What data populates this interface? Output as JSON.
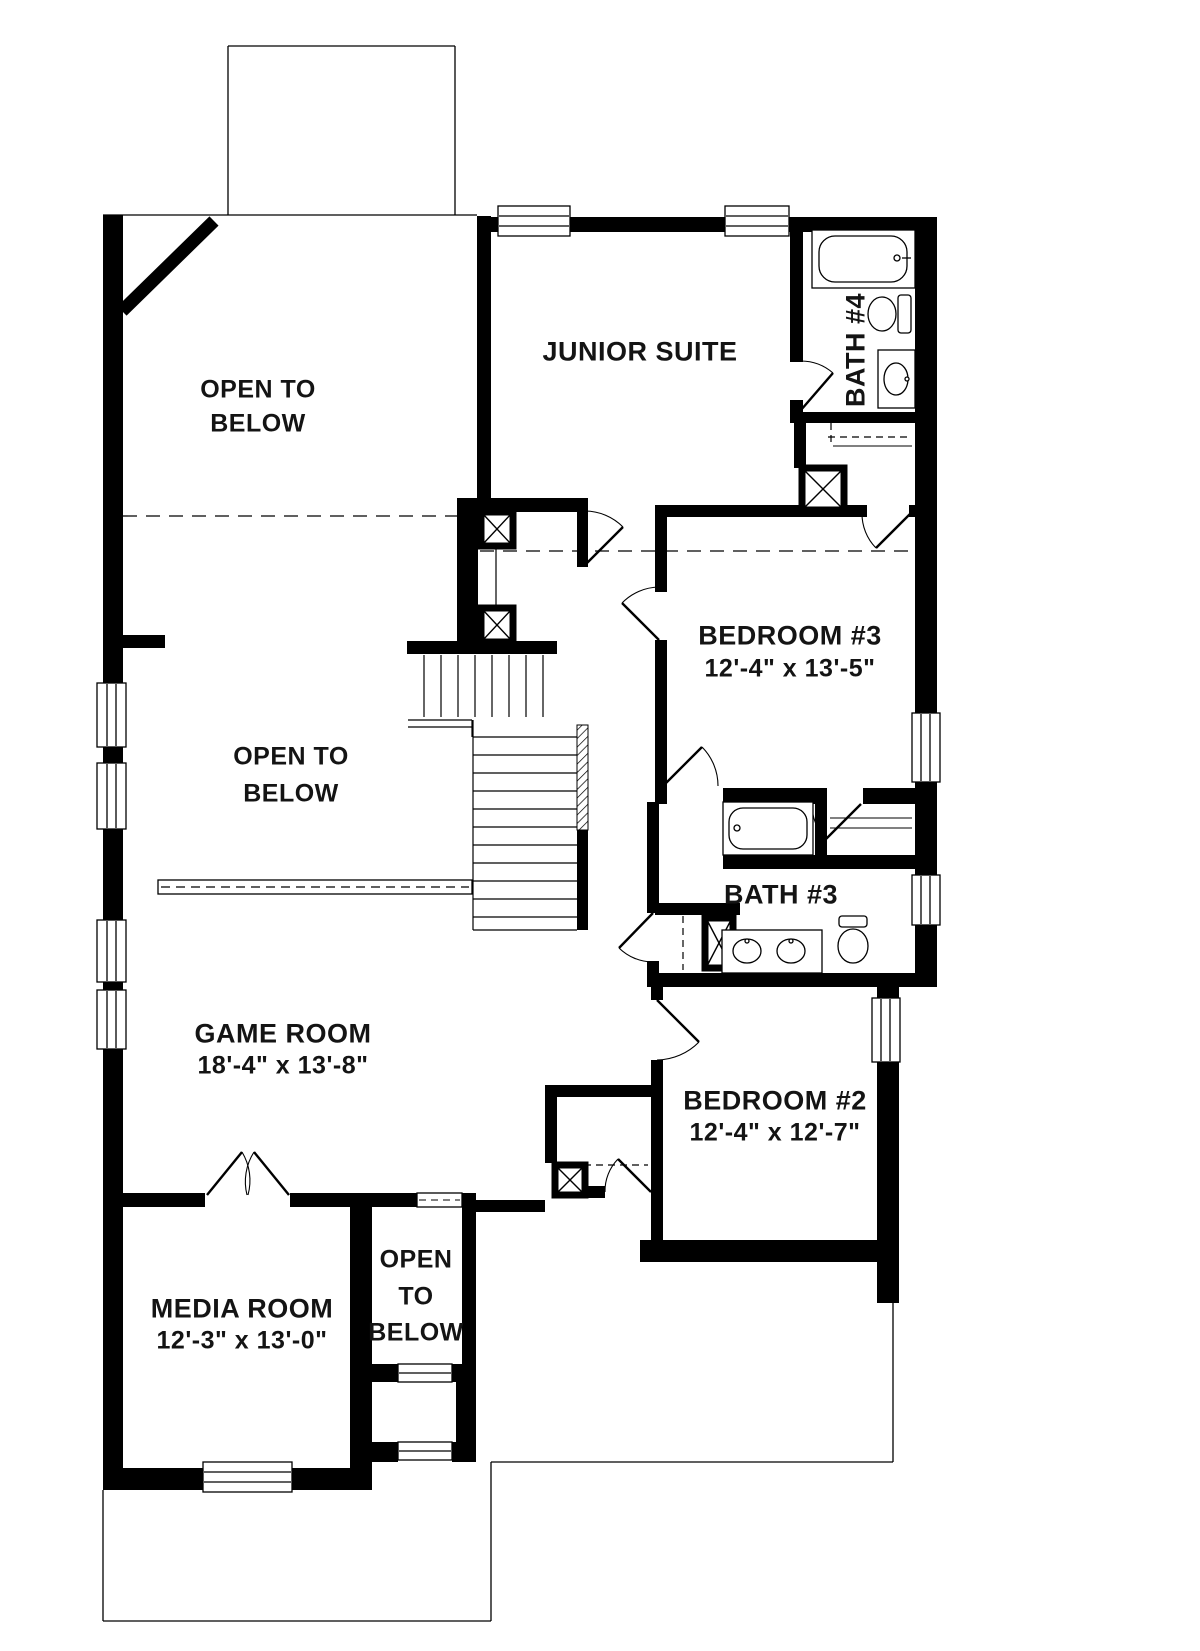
{
  "document_type": "floor-plan",
  "colors": {
    "wall": "#000000",
    "background": "#ffffff",
    "text": "#141414"
  },
  "rooms": {
    "open_below_top": {
      "line1": "OPEN TO",
      "line2": "BELOW"
    },
    "junior_suite": {
      "name": "JUNIOR SUITE"
    },
    "bath4": {
      "name": "BATH #4"
    },
    "bedroom3": {
      "name": "BEDROOM #3",
      "dims": "12'-4\" x 13'-5\""
    },
    "open_below_mid": {
      "line1": "OPEN TO",
      "line2": "BELOW"
    },
    "bath3": {
      "name": "BATH #3"
    },
    "game_room": {
      "name": "GAME ROOM",
      "dims": "18'-4\" x 13'-8\""
    },
    "bedroom2": {
      "name": "BEDROOM #2",
      "dims": "12'-4\" x 12'-7\""
    },
    "media_room": {
      "name": "MEDIA ROOM",
      "dims": "12'-3\" x 13'-0\""
    },
    "open_below_bottom": {
      "line1": "OPEN",
      "line2": "TO",
      "line3": "BELOW"
    }
  }
}
